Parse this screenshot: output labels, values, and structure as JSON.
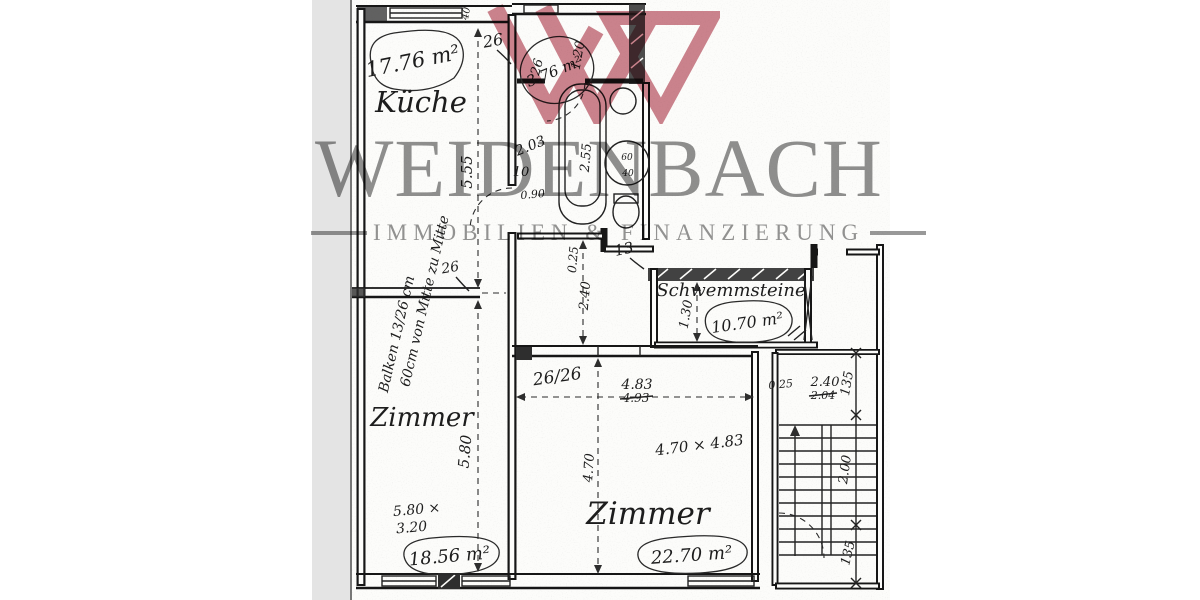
{
  "watermark": {
    "brand": "WEIDENBACH",
    "tagline": "IMMOBILIEN & FINANZIERUNG",
    "text_color": "#8e8e8e",
    "logo_color": "#c26976"
  },
  "plan": {
    "rooms": {
      "kueche": {
        "label": "Küche",
        "area": "17.76 m²"
      },
      "bad": {
        "area": "3.76 m²"
      },
      "schwemmsteine": {
        "label": "Schwemmsteine",
        "area": "10.70 m²"
      },
      "zimmer_links": {
        "label": "Zimmer",
        "area": "18.56 m²",
        "size_line1": "5.80 ×",
        "size_line2": "3.20"
      },
      "zimmer_mitte": {
        "label": "Zimmer",
        "area": "22.70 m²",
        "size_note": "4.70 × 4.83"
      }
    },
    "dims": {
      "d40_top": "40",
      "d26_top": "26",
      "d555": "5.55",
      "d26_bad": "26",
      "d120": "1.20",
      "d203": "2.03",
      "d10_door": "10",
      "d090": "0.90",
      "d255": "2.55",
      "d60_circle": "60",
      "d40_circle": "40",
      "d025_flur": "0.25",
      "d240_flur": "2.40",
      "d13": "13",
      "d130": "1.30",
      "d26_26": "26/26",
      "d483": "4.83",
      "d493_struck": "4.93",
      "d025_stair": "0.25",
      "d240_stair": "2.40",
      "d204_struck": "2.04",
      "d135_top": "135",
      "d200_stair": "2.00",
      "d135_bottom": "135",
      "d580": "5.80",
      "d470": "4.70",
      "d26_beam": "26"
    },
    "notes": {
      "balken": "Balken 13/26 cm",
      "abstand": "60cm von Mitte zu Mitte"
    }
  }
}
